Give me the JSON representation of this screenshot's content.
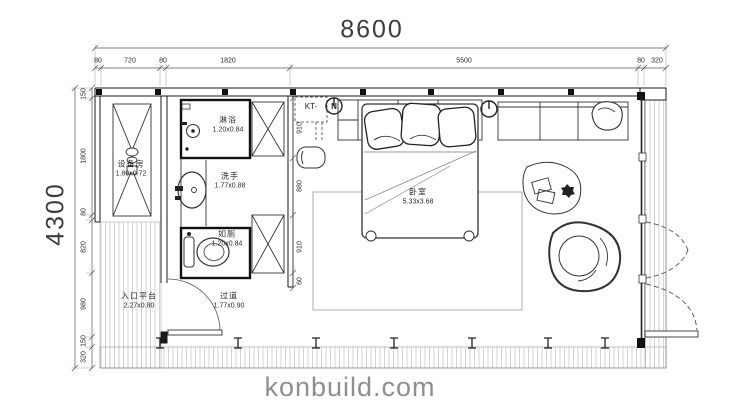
{
  "dims": {
    "width_total": "8600",
    "height_total": "4300",
    "top_chain": [
      "80",
      "720",
      "80",
      "1820",
      "5500",
      "80",
      "320"
    ],
    "left_chain": [
      "150",
      "1800",
      "80",
      "820",
      "980",
      "150",
      "320"
    ],
    "inner_chain": [
      "910",
      "880",
      "910",
      "60"
    ]
  },
  "rooms": {
    "equipment": {
      "name": "设备房",
      "size": "1.80x0.72"
    },
    "shower": {
      "name": "淋浴",
      "size": "1.20x0.84"
    },
    "wash": {
      "name": "洗手",
      "size": "1.77x0.88"
    },
    "toilet": {
      "name": "如厕",
      "size": "1.20x0.84"
    },
    "corridor": {
      "name": "过道",
      "size": "1.77x0.90"
    },
    "entry": {
      "name": "入口平台",
      "size": "2.27x0.80"
    },
    "bedroom": {
      "name": "卧室",
      "size": "5.33x3.68"
    }
  },
  "annotations": {
    "kt": "KT-",
    "kt_symbol": "N"
  },
  "watermark": "konbuild.com",
  "colors": {
    "line": "#333333",
    "wall": "#1a1a1a",
    "hatch": "#c9c9c9",
    "watermark": "#8f8f8f"
  }
}
